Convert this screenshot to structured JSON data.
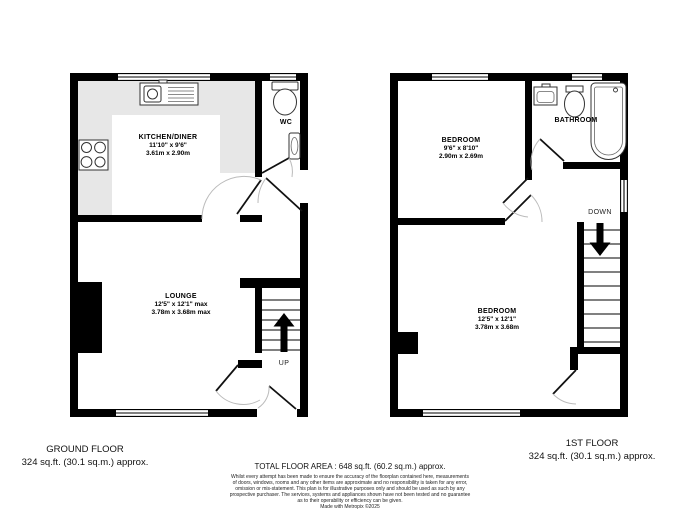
{
  "floors": {
    "ground": {
      "caption_title": "GROUND FLOOR",
      "caption_area": "324 sq.ft. (30.1 sq.m.) approx.",
      "kitchen": {
        "name": "KITCHEN/DINER",
        "imperial": "11'10\" x 9'6\"",
        "metric": "3.61m x 2.90m"
      },
      "wc": {
        "name": "WC"
      },
      "lounge": {
        "name": "LOUNGE",
        "imperial": "12'5\" x 12'1\" max",
        "metric": "3.78m x 3.68m max"
      },
      "stairs_label": "UP"
    },
    "first": {
      "caption_title": "1ST FLOOR",
      "caption_area": "324 sq.ft. (30.1 sq.m.) approx.",
      "bedroom1": {
        "name": "BEDROOM",
        "imperial": "9'6\" x 8'10\"",
        "metric": "2.90m x 2.69m"
      },
      "bathroom": {
        "name": "BATHROOM"
      },
      "bedroom2": {
        "name": "BEDROOM",
        "imperial": "12'5\" x 12'1\"",
        "metric": "3.78m x 3.68m"
      },
      "stairs_label": "DOWN"
    }
  },
  "footer": {
    "total_area": "TOTAL FLOOR AREA : 648 sq.ft. (60.2 sq.m.) approx.",
    "disclaimer_lines": [
      "Whilst every attempt has been made to ensure the accuracy of the floorplan contained here, measurements",
      "of doors, windows, rooms and any other items are approximate and no responsibility is taken for any error,",
      "omission or mis-statement. This plan is for illustrative purposes only and should be used as such by any",
      "prospective purchaser. The services, systems and appliances shown have not been tested and no guarantee",
      "as to their operability or efficiency can be given.",
      "Made with Metropix ©2025"
    ]
  },
  "colors": {
    "wall": "#000000",
    "counter": "#e7e7e7",
    "fixture": "#333333",
    "door_arc": "#bbbbbb"
  }
}
